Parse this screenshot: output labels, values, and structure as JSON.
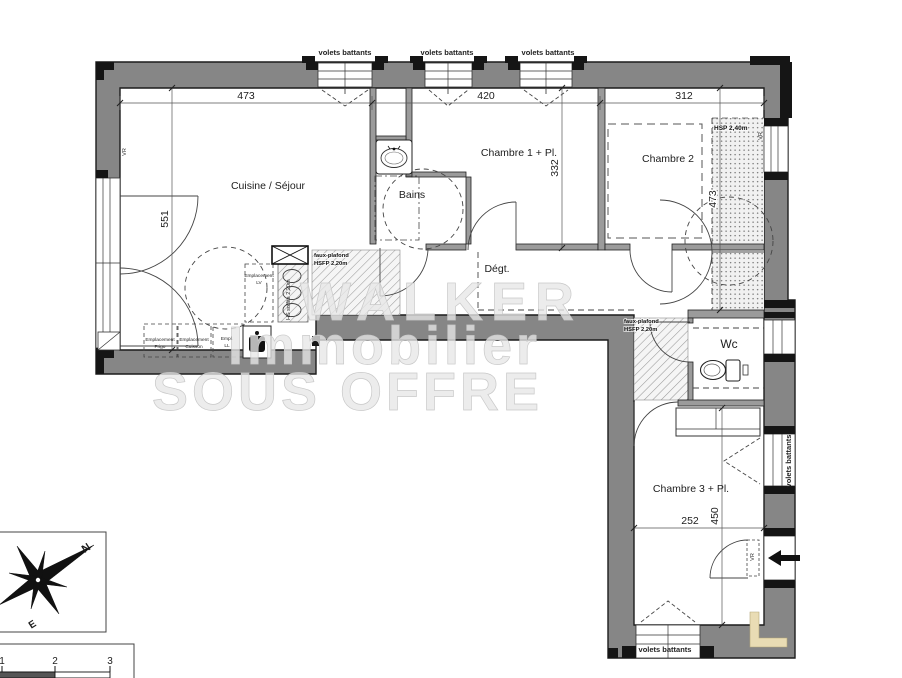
{
  "plan": {
    "rooms": {
      "cuisine": "Cuisine / Séjour",
      "bains": "Bains",
      "chambre1": "Chambre 1 + Pl.",
      "chambre2": "Chambre 2",
      "degagement": "Dégt.",
      "wc": "Wc",
      "chambre3": "Chambre 3 + Pl."
    },
    "dimensions": {
      "top_left": "473",
      "top_center": "420",
      "top_right": "312",
      "left_height": "551",
      "chambre1_height": "332",
      "right_height": "473",
      "chambre3_height": "450",
      "chambre3_width": "252"
    },
    "annotations": {
      "volets": "volets battants",
      "vr": "VR",
      "hsp": "HSP 2,40m",
      "faux_plafond_line1": "faux-plafond",
      "faux_plafond_line2": "HSFP 2,20m",
      "hs_soffite": "HS soffite 2,20m",
      "emplacement": "Emplacement",
      "lv": "LV",
      "frigo": "Frigo",
      "cuisson": "Cuisson",
      "empl_abbrev": "Empl.",
      "ll": "LL"
    }
  },
  "watermark": {
    "line1": "WALKER",
    "line2": "Immobilier",
    "line3": "SOUS OFFRE"
  },
  "compass": {
    "north": "N",
    "east": "E"
  },
  "scale_bar": {
    "tick1": "1",
    "tick2": "2",
    "tick3": "3"
  },
  "colors": {
    "wall": "#868686",
    "black": "#151515",
    "beige": "#e9dcb4"
  }
}
